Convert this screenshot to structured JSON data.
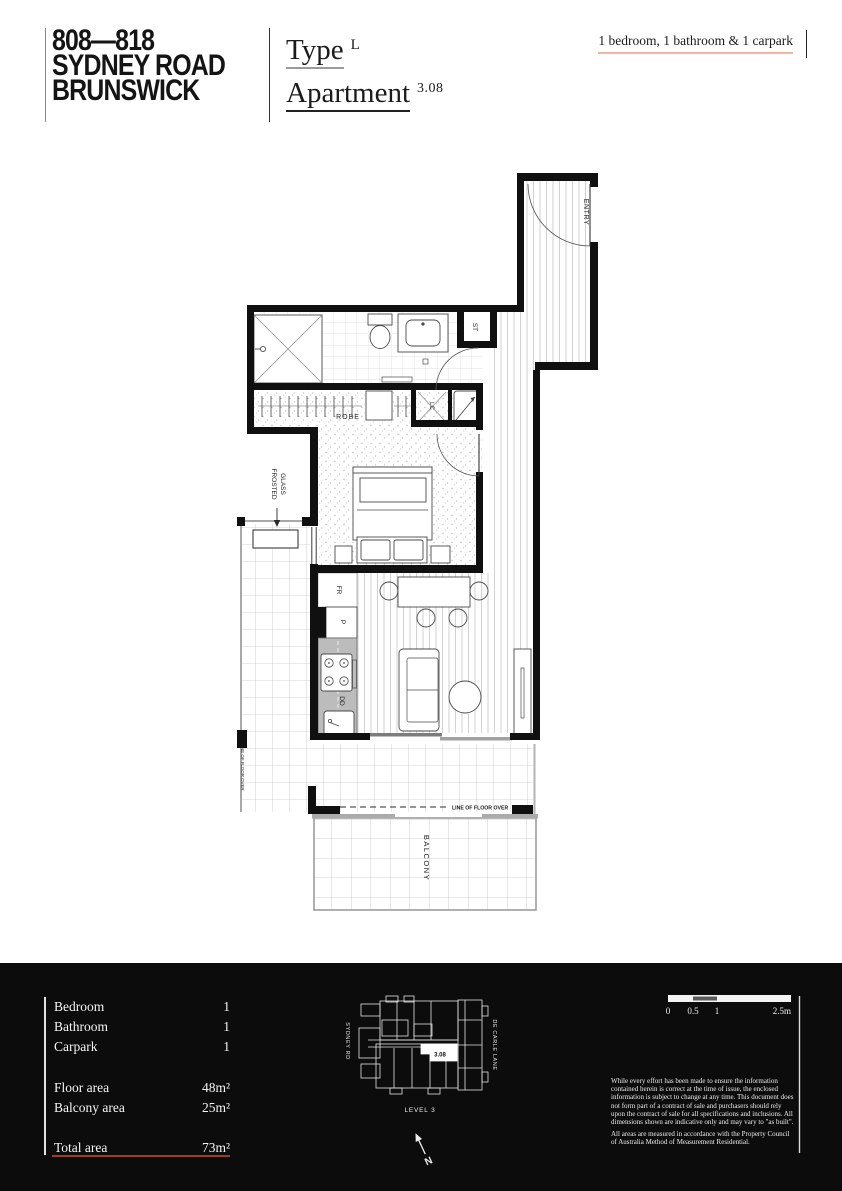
{
  "header": {
    "project_title_lines": [
      "808—818",
      "SYDNEY ROAD",
      "BRUNSWICK"
    ],
    "type_label": "Type",
    "type_value": "L",
    "apartment_label": "Apartment",
    "apartment_number": "3.08",
    "summary": "1 bedroom, 1 bathroom & 1 carpark"
  },
  "plan": {
    "labels": {
      "entry": "ENTRY",
      "st": "ST",
      "robe": "ROBE",
      "lc": "LC",
      "fr": "FR",
      "pantry": "P",
      "dd": "DD",
      "ac": "A/C",
      "frosted_glass_line1": "FROSTED",
      "frosted_glass_line2": "GLASS",
      "balcony": "BALCONY",
      "line_of_floor_over_left": "LINE OF FLOOR OVER",
      "line_of_floor_over_bottom": "LINE OF FLOOR OVER"
    }
  },
  "footer": {
    "stats": [
      {
        "label": "Bedroom",
        "value": "1"
      },
      {
        "label": "Bathroom",
        "value": "1"
      },
      {
        "label": "Carpark",
        "value": "1"
      },
      {
        "label": "Floor area",
        "value": "48m²"
      },
      {
        "label": "Balcony area",
        "value": "25m²"
      },
      {
        "label": "Total area",
        "value": "73m²"
      }
    ],
    "keyplan": {
      "street_left": "SYDNEY RD",
      "street_right": "DE CARLE LANE",
      "level": "LEVEL 3",
      "unit": "3.08",
      "north": "N"
    },
    "scalebar": {
      "t0": "0",
      "t05": "0.5",
      "t1": "1",
      "t25": "2.5m"
    },
    "disclaimer": [
      "While every effort has been made to ensure the information contained herein is correct at the time of issue, the enclosed information is subject to change at any time. This document does not form part of a contract of sale and purchasers should rely upon the contract of sale for all specifications and inclusions. All dimensions shown are indicative only and may vary to \"as built\".",
      "All areas are measured in accordance with the Property Council of Australia Method of Measurement Residential."
    ]
  },
  "colors": {
    "accent_salmon": "#f4b39e",
    "accent_red": "#9c3f26",
    "footer_bg": "#0c0c0c"
  }
}
